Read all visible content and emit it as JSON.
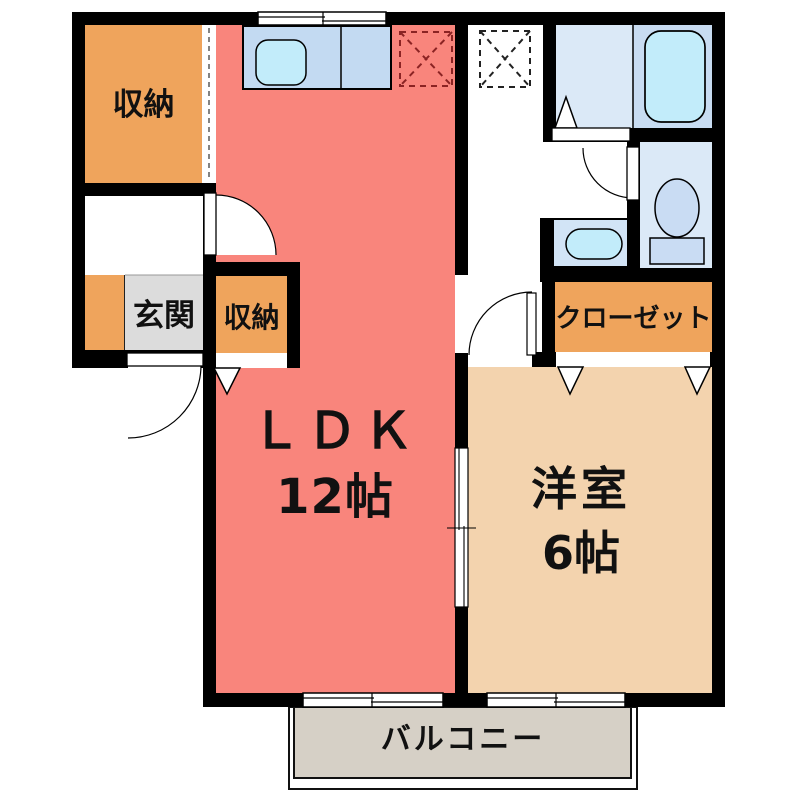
{
  "rooms": {
    "storage_top": {
      "label": "収納"
    },
    "storage_ldk": {
      "label": "収納"
    },
    "entrance": {
      "label": "玄関"
    },
    "ldk": {
      "label": "ＬＤＫ",
      "size": "12帖"
    },
    "closet": {
      "label": "クローゼット"
    },
    "western": {
      "label": "洋室",
      "size": "6帖"
    },
    "balcony": {
      "label": "バルコニー"
    }
  },
  "colors": {
    "wall": "#000000",
    "ldk": "#f9857c",
    "storage": "#efa45c",
    "western": "#f3d3ae",
    "entrance": "#dcdcdc",
    "balcony": "#d6d0c6",
    "room_blue": "#dbe9f7",
    "tub_zone": "#c8dcf2",
    "counter_blue": "#c3daf2",
    "basin_blue": "#d2e4f6",
    "fixture_cyan": "#c2ecfa",
    "toilet_blue": "#c9dcf3",
    "fridge_dash": "#8b2323",
    "washer_dash": "#222222"
  }
}
